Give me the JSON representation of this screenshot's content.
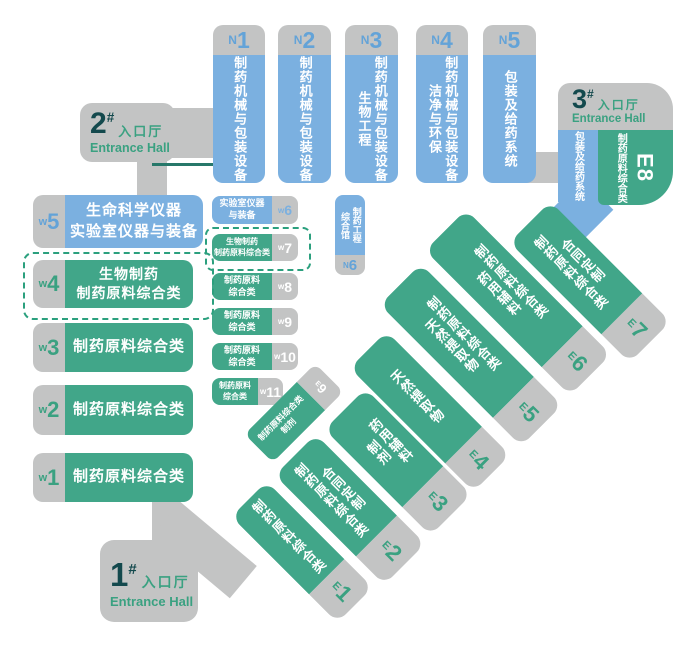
{
  "colors": {
    "gray": "#c3c4c4",
    "blue": "#7bb0e0",
    "green": "#41a689",
    "number_blue": "#63a3d8",
    "number_green": "#3aa181",
    "dark_teal": "#13494d",
    "dashed_border": "#2ba07e"
  },
  "entrances": [
    {
      "num": "1",
      "hash": "#",
      "cn": "入口厅",
      "en": "Entrance Hall"
    },
    {
      "num": "2",
      "hash": "#",
      "cn": "入口厅",
      "en": "Entrance Hall"
    },
    {
      "num": "3",
      "hash": "#",
      "cn": "入口厅",
      "en": "Entrance Hall"
    }
  ],
  "halls": {
    "n_top": [
      {
        "prefix": "N",
        "num": "1",
        "lines": [
          "制药机械与包装设备"
        ]
      },
      {
        "prefix": "N",
        "num": "2",
        "lines": [
          "制药机械与包装设备"
        ]
      },
      {
        "prefix": "N",
        "num": "3",
        "lines": [
          "制药机械与包装设备",
          "生物工程"
        ]
      },
      {
        "prefix": "N",
        "num": "4",
        "lines": [
          "制药机械与包装设备",
          "洁净与环保"
        ]
      },
      {
        "prefix": "N",
        "num": "5",
        "lines": [
          "包装及给药系统"
        ]
      }
    ],
    "n6": {
      "prefix": "N",
      "num": "6",
      "lines": [
        "制药工程",
        "综合馆"
      ]
    },
    "w_large": [
      {
        "prefix": "w",
        "num": "5",
        "lines": [
          "生命科学仪器",
          "实验室仪器与装备"
        ]
      },
      {
        "prefix": "w",
        "num": "4",
        "lines": [
          "生物制药",
          "制药原料综合类"
        ]
      },
      {
        "prefix": "w",
        "num": "3",
        "lines": [
          "制药原料综合类"
        ]
      },
      {
        "prefix": "w",
        "num": "2",
        "lines": [
          "制药原料综合类"
        ]
      },
      {
        "prefix": "w",
        "num": "1",
        "lines": [
          "制药原料综合类"
        ]
      }
    ],
    "w_small": [
      {
        "prefix": "w",
        "num": "6",
        "lines": [
          "实验室仪器",
          "与装备"
        ]
      },
      {
        "prefix": "w",
        "num": "7",
        "lines": [
          "生物制药",
          "制药原料综合类"
        ]
      },
      {
        "prefix": "w",
        "num": "8",
        "lines": [
          "制药原料",
          "综合类"
        ]
      },
      {
        "prefix": "w",
        "num": "9",
        "lines": [
          "制药原料",
          "综合类"
        ]
      },
      {
        "prefix": "w",
        "num": "10",
        "lines": [
          "制药原料",
          "综合类"
        ]
      },
      {
        "prefix": "w",
        "num": "11",
        "lines": [
          "制药原料",
          "综合类"
        ]
      }
    ],
    "e_diag": [
      {
        "prefix": "E",
        "num": "1",
        "lines": [
          "制药原料综合类"
        ]
      },
      {
        "prefix": "E",
        "num": "2",
        "lines": [
          "合同定制",
          "制药原料综合类"
        ]
      },
      {
        "prefix": "E",
        "num": "3",
        "lines": [
          "药用辅料",
          "制剂"
        ]
      },
      {
        "prefix": "E",
        "num": "4",
        "lines": [
          "天然提取物"
        ]
      },
      {
        "prefix": "E",
        "num": "5",
        "lines": [
          "制药原料综合类",
          "天然提取物"
        ]
      },
      {
        "prefix": "E",
        "num": "6",
        "lines": [
          "制药原料综合类",
          "药用辅料"
        ]
      },
      {
        "prefix": "E",
        "num": "7",
        "lines": [
          "合同定制",
          "制药原料综合类"
        ]
      }
    ],
    "e9": {
      "prefix": "E",
      "num": "9",
      "lines": [
        "制药原料综合类",
        "制剂"
      ]
    },
    "e8": {
      "prefix": "E",
      "num": "8",
      "blue_lines": [
        "包装及",
        "给药系统"
      ],
      "green_lines": [
        "制药原料",
        "综合类"
      ]
    }
  }
}
